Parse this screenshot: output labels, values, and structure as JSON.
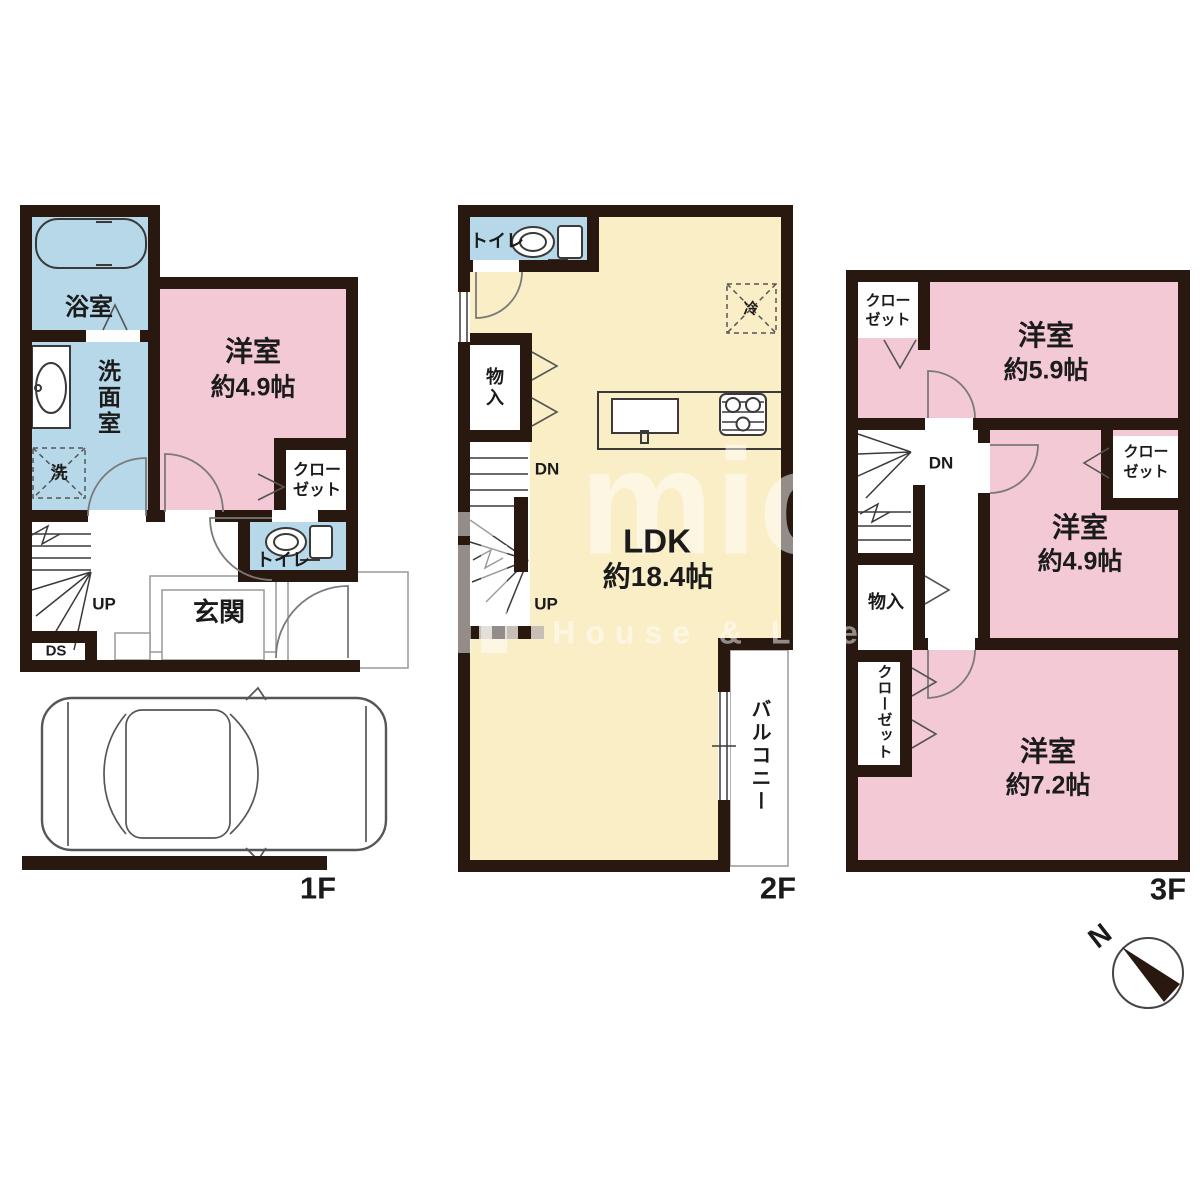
{
  "floors": {
    "f1": {
      "tag": "1F",
      "bath": "浴室",
      "washroom": "洗面室",
      "washer": "洗",
      "room_name": "洋室",
      "room_size": "約4.9帖",
      "closet_line1": "クロー",
      "closet_line2": "ゼット",
      "toilet": "トイレ",
      "entrance": "玄関",
      "up": "UP",
      "ds": "DS"
    },
    "f2": {
      "tag": "2F",
      "toilet": "トイレ",
      "fridge": "冷",
      "storage": "物入",
      "dn": "DN",
      "up": "UP",
      "ldk_name": "LDK",
      "ldk_size": "約18.4帖",
      "balcony": "バルコニー"
    },
    "f3": {
      "tag": "3F",
      "closet_a_line1": "クロー",
      "closet_a_line2": "ゼット",
      "room59_name": "洋室",
      "room59_size": "約5.9帖",
      "dn": "DN",
      "closet_b_line1": "クロー",
      "closet_b_line2": "ゼット",
      "room49_name": "洋室",
      "room49_size": "約4.9帖",
      "storage": "物入",
      "closet_c": "クローゼット",
      "room72_name": "洋室",
      "room72_size": "約7.2帖"
    }
  },
  "compass": {
    "north_label": "N"
  },
  "watermark": {
    "logo_text": "mic",
    "tagline": "House & Life"
  },
  "colors": {
    "wall": "#281810",
    "western_room_fill": "#f3c9d6",
    "wet_area_fill": "#b7d8e9",
    "ldk_fill": "#faeec6"
  }
}
